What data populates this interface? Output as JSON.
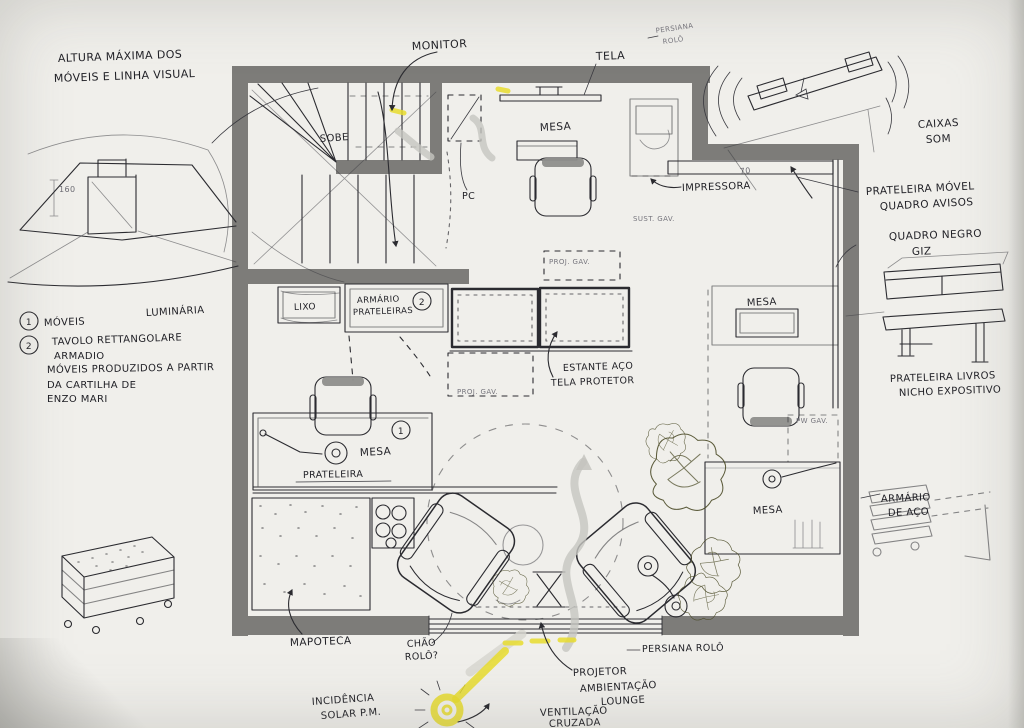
{
  "meta": {
    "description": "Hand-drawn floor plan sketch of a home office / studio with lounge, in Portuguese"
  },
  "colors": {
    "paper": "#f0efeb",
    "wall_gray": "#7d7c79",
    "ink": "#2b2b30",
    "marker_gray": "#c6c5c0",
    "highlight_yellow": "#e7dc2e",
    "plant_green": "#4c4c28",
    "chair_back_gray": "#8e8e8c"
  },
  "labels": {
    "altura1": "ALTURA MÁXIMA DOS",
    "altura2": "MÓVEIS E LINHA VISUAL",
    "dim160": "160",
    "monitor": "MONITOR",
    "tela": "TELA",
    "persiana_top1": "PERSIANA",
    "persiana_top2": "ROLÔ",
    "caixas1": "CAIXAS",
    "caixas2": "SOM",
    "sobe": "SOBE",
    "mesa_sup": "MESA",
    "pc": "PC",
    "impressora": "IMPRESSORA",
    "sust_gav": "SUST. GAV.",
    "dim70": "70",
    "prat_movel1": "PRATELEIRA MÓVEL",
    "prat_movel2": "QUADRO AVISOS",
    "quadro1": "QUADRO NEGRO",
    "quadro2": "GIZ",
    "lixo": "LIXO",
    "armario1": "ARMÁRIO",
    "armario2": "PRATELEIRAS",
    "circ2_box": "2",
    "proj_gav_a": "PROJ. GAV.",
    "proj_gav_b": "PROJ. GAV.",
    "estante1": "ESTANTE AÇO",
    "estante2": "TELA PROTETOR",
    "mesa_dir_sup": "MESA",
    "luminaria": "LUMINÁRIA",
    "leg_n1": "1",
    "leg_item1": "MÓVEIS",
    "leg_n2": "2",
    "leg_item2a": "TAVOLO RETTANGOLARE",
    "leg_item2b": "ARMADIO",
    "enzo1": "MÓVEIS PRODUZIDOS A PARTIR",
    "enzo2": "DA CARTILHA DE",
    "enzo3": "ENZO MARI",
    "mesa_esq": "MESA",
    "circ1_desk": "1",
    "prateleira": "PRATELEIRA",
    "prat_livros1": "PRATELEIRA LIVROS",
    "prat_livros2": "NICHO EXPOSITIVO",
    "armario_aco1": "ARMÁRIO",
    "armario_aco2": "DE AÇO",
    "mesa_dir_inf": "MESA",
    "pw_gav": "PW GAV.",
    "mapoteca": "MAPOTECA",
    "chao1": "CHÃO",
    "chao2": "ROLÔ?",
    "incid1": "INCIDÊNCIA",
    "incid2": "SOLAR P.M.",
    "projetor": "PROJETOR",
    "amb1": "AMBIENTAÇÃO",
    "amb2": "LOUNGE",
    "vent1": "VENTILAÇÃO",
    "vent2": "CRUZADA",
    "persiana_inf": "PERSIANA ROLÔ"
  }
}
